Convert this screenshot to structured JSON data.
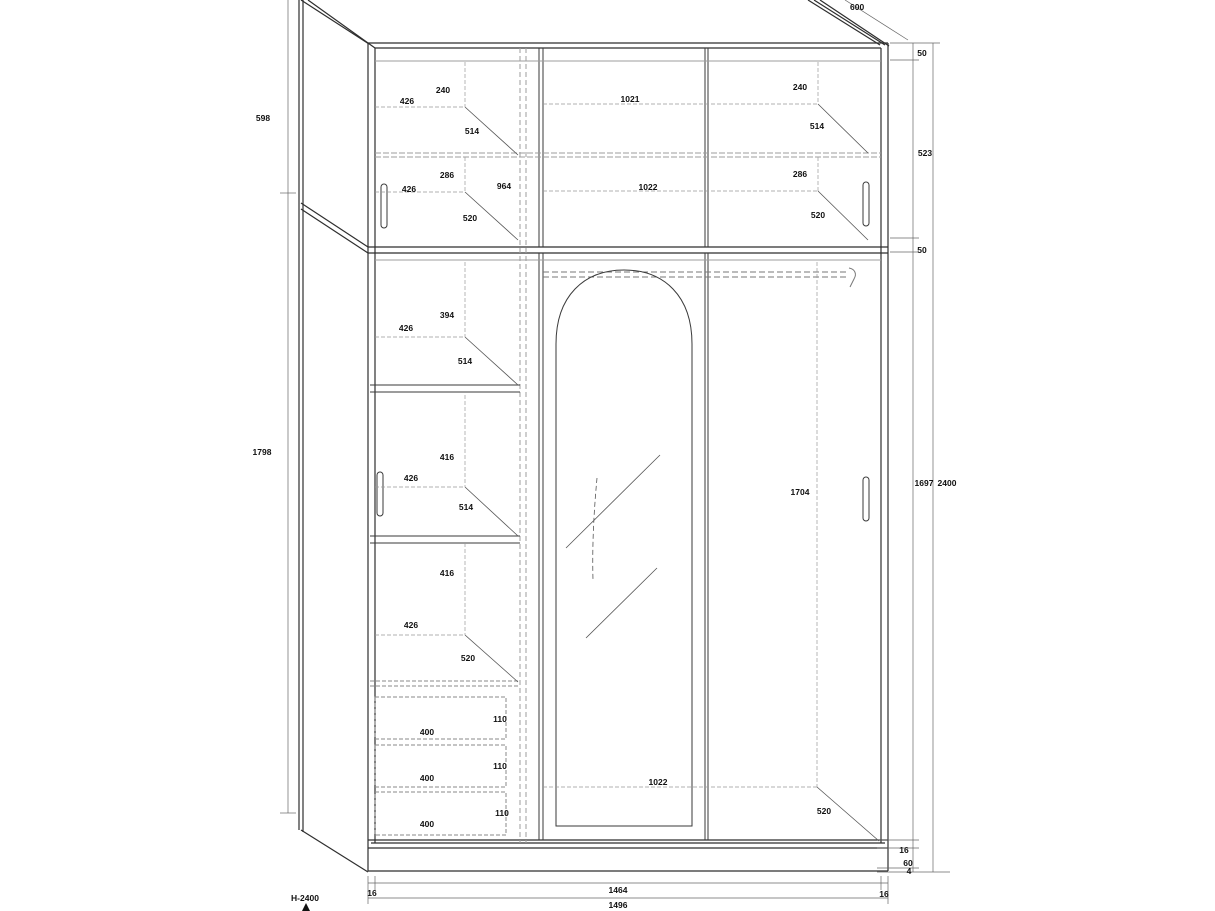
{
  "drawing": {
    "type": "furniture-technical-drawing",
    "subject": "three-door wardrobe front view with shelf, drawer and dimension annotations",
    "colors": {
      "line": "#2e2e2e",
      "hidden_line": "#9e9e9e",
      "dimension_line": "#666666",
      "text": "#111111",
      "background": "#ffffff"
    }
  },
  "dims": {
    "top_depth": "600",
    "left_upper_height": "598",
    "left_lower_height": "1798",
    "floor_note": "H-2400",
    "right_top_gap": "50",
    "right_upper_inner": "523",
    "right_divider": "50",
    "right_lower_inner": "1697",
    "right_total_height": "2400",
    "right_base_top": "16",
    "right_plinth": "60",
    "right_floor_gap": "4",
    "bottom_right_inset": "16",
    "bottom_inner_width": "1464",
    "bottom_left_inset": "16",
    "bottom_total_width": "1496",
    "ul_240": "240",
    "ul_426_top": "426",
    "ul_514": "514",
    "ul_286": "286",
    "ul_426_bottom": "426",
    "ul_964": "964",
    "ul_520": "520",
    "ur_240": "240",
    "ur_1021": "1021",
    "ur_514": "514",
    "ur_286": "286",
    "ur_1022": "1022",
    "ur_520": "520",
    "ll_394": "394",
    "ll_426_1": "426",
    "ll_514_1": "514",
    "ll_416_1": "416",
    "ll_426_2": "426",
    "ll_514_2": "514",
    "ll_416_2": "416",
    "ll_426_3": "426",
    "ll_520": "520",
    "drawer1_height": "110",
    "drawer1_width": "400",
    "drawer2_height": "110",
    "drawer2_width": "400",
    "drawer3_height": "110",
    "drawer3_width": "400",
    "mid_bottom_1022": "1022",
    "bottom_right_depth_520": "520",
    "right_inner_height_1704": "1704"
  }
}
